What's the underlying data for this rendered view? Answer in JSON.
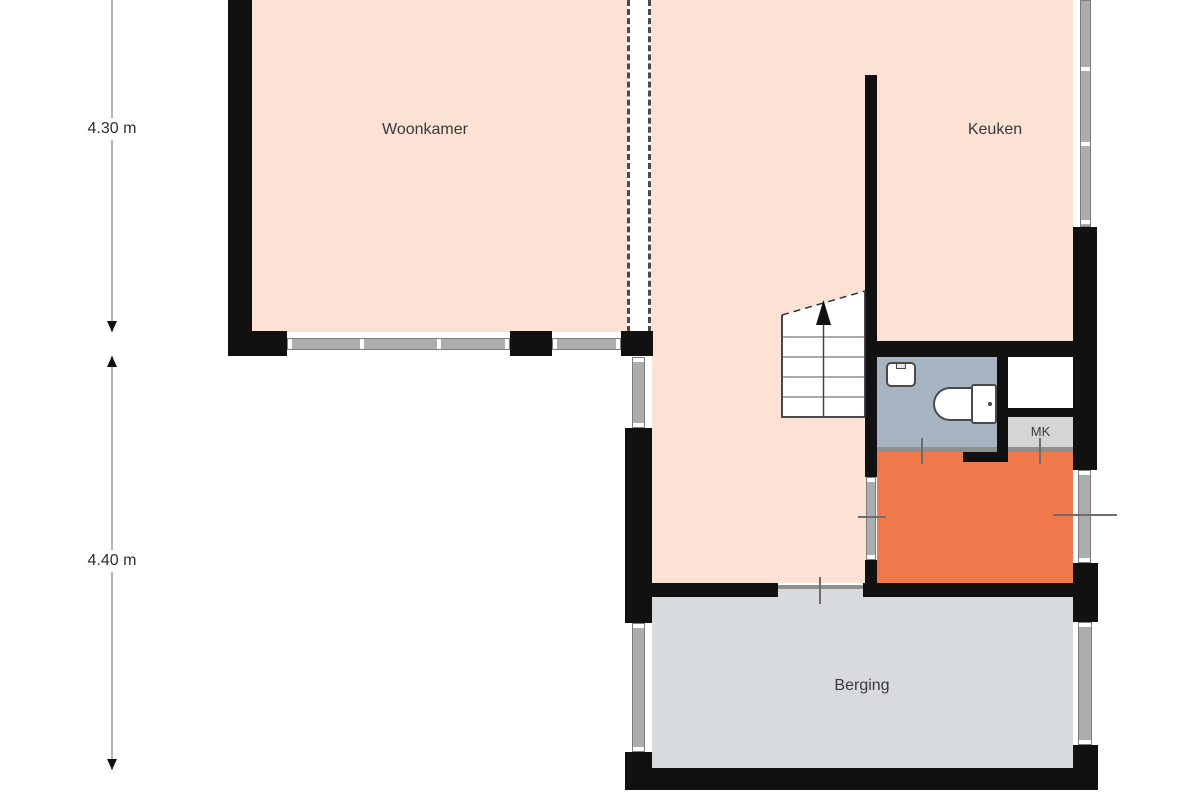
{
  "rooms": {
    "woonkamer": {
      "label": "Woonkamer",
      "color": "#fbe2d4"
    },
    "keuken": {
      "label": "Keuken",
      "color": "#fbe2d4"
    },
    "hal": {
      "color": "#fbe2d4"
    },
    "entree": {
      "color": "#f0794c"
    },
    "toilet": {
      "color": "#a7b5c3"
    },
    "kast": {
      "color": "#ffffff"
    },
    "mk": {
      "label": "MK",
      "color": "#d3d5d6"
    },
    "berging": {
      "label": "Berging",
      "color": "#d7dbdd"
    }
  },
  "dimensions": {
    "top": {
      "label": "4.30 m"
    },
    "bottom": {
      "label": "4.40 m"
    }
  },
  "palette": {
    "wall": "#111111",
    "window": "#adadad",
    "dimension_line": "#b3b3b3",
    "text": "#3a3a3a"
  }
}
